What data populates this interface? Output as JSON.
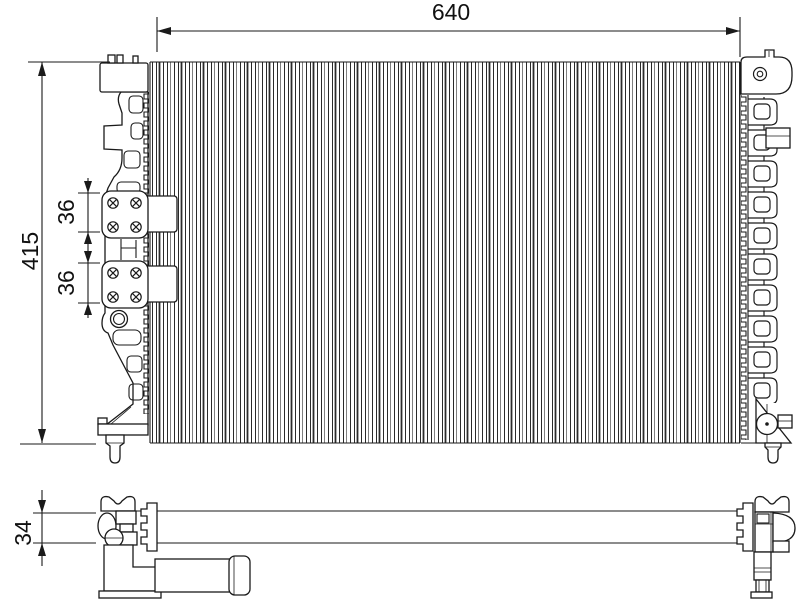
{
  "colors": {
    "line": "#1a1a1a",
    "text": "#111111",
    "background": "#ffffff"
  },
  "dimensions": {
    "core_width": "640",
    "overall_height": "415",
    "upper_plate_height": "36",
    "lower_plate_height": "36",
    "profile_depth": "34"
  }
}
